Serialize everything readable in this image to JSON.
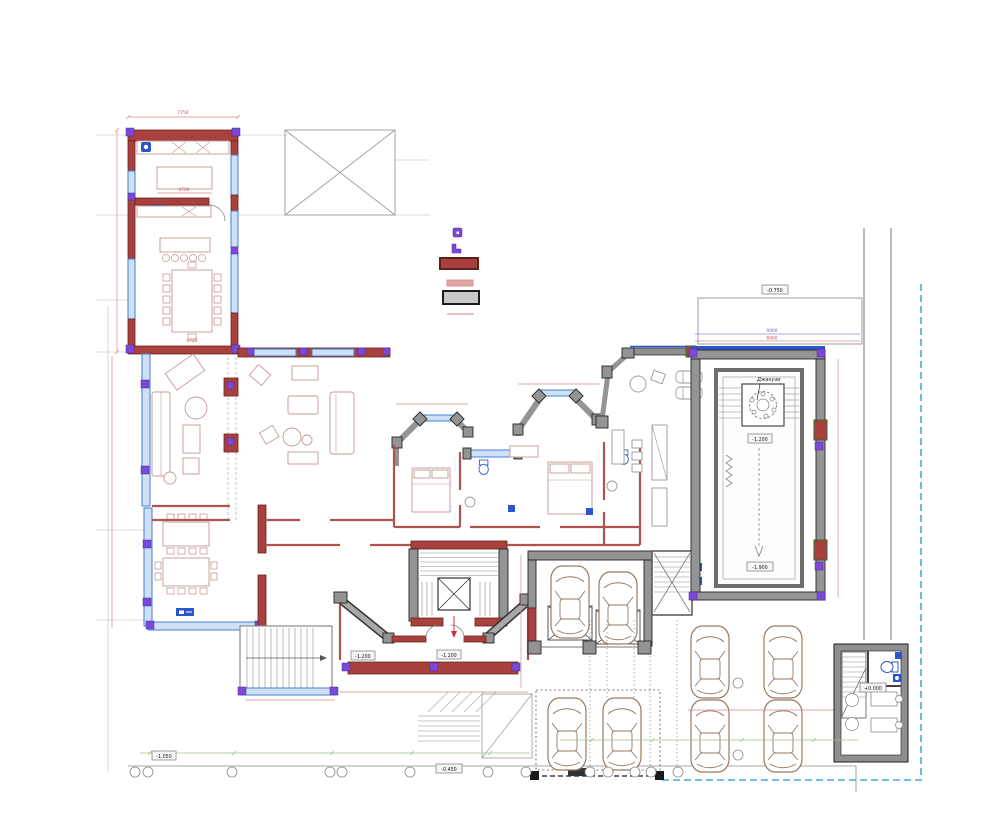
{
  "document": {
    "type": "architectural-floor-plan",
    "description": "Ground floor plan of a villa with indoor pool, garage, forecourt parking and guard house",
    "background": "#ffffff"
  },
  "palette": {
    "masonry_wall": "#a8403e",
    "masonry_wall_dark": "#6b211f",
    "partition_wall": "#e2a7a4",
    "concrete_wall": "#949494",
    "concrete_dark": "#262626",
    "glazing_blue": "#3f7fd4",
    "glazing_fill": "#cfe0f5",
    "accent_purple": "#7a49d6",
    "marker_blue": "#2b55cc",
    "dimension_red": "#d98c8c",
    "dimension_purple": "#9b8ad0",
    "dimension_green": "#a5c08a",
    "boundary_blue": "#45a9e0",
    "vehicle_brown": "#9a7a61",
    "furniture_line": "#c49a94",
    "hairline_gray": "#bdbdbd"
  },
  "legend": {
    "items": [
      {
        "name": "point-marker-square",
        "color": "#7a49d6"
      },
      {
        "name": "point-marker-corner",
        "color": "#7a49d6"
      },
      {
        "name": "masonry-wall-swatch",
        "color": "#a8403e"
      },
      {
        "name": "partition-wall-swatch",
        "color": "#e2a7a4"
      },
      {
        "name": "reinforced-concrete-wall-swatch",
        "color": "#c9c9c9"
      },
      {
        "name": "axis-line-swatch",
        "color": "#d98c8c"
      }
    ]
  },
  "annotations": {
    "jacuzzi_callout": "Джакузи",
    "elevations": {
      "terrace": "-0.750",
      "pool_shallow": "-1.200",
      "pool_deep": "-1.900",
      "entrance_left": "-1.200",
      "entrance_right": "-1.200",
      "site_southwest": "-1.050",
      "site_south": "-0.450",
      "guard_house": "+0.000"
    },
    "dimensions": {
      "kitchen_wing_width": "7750",
      "kitchen_island": "4700",
      "dining_table_span": "4725",
      "pool_wing_upper": "9400",
      "pool_wing_lower": "8400"
    }
  },
  "vehicles": {
    "garage_cars": 2,
    "forecourt_cars": 6
  },
  "site": {
    "boundary_style": "dashed",
    "boundary_color": "#45a9e0"
  }
}
